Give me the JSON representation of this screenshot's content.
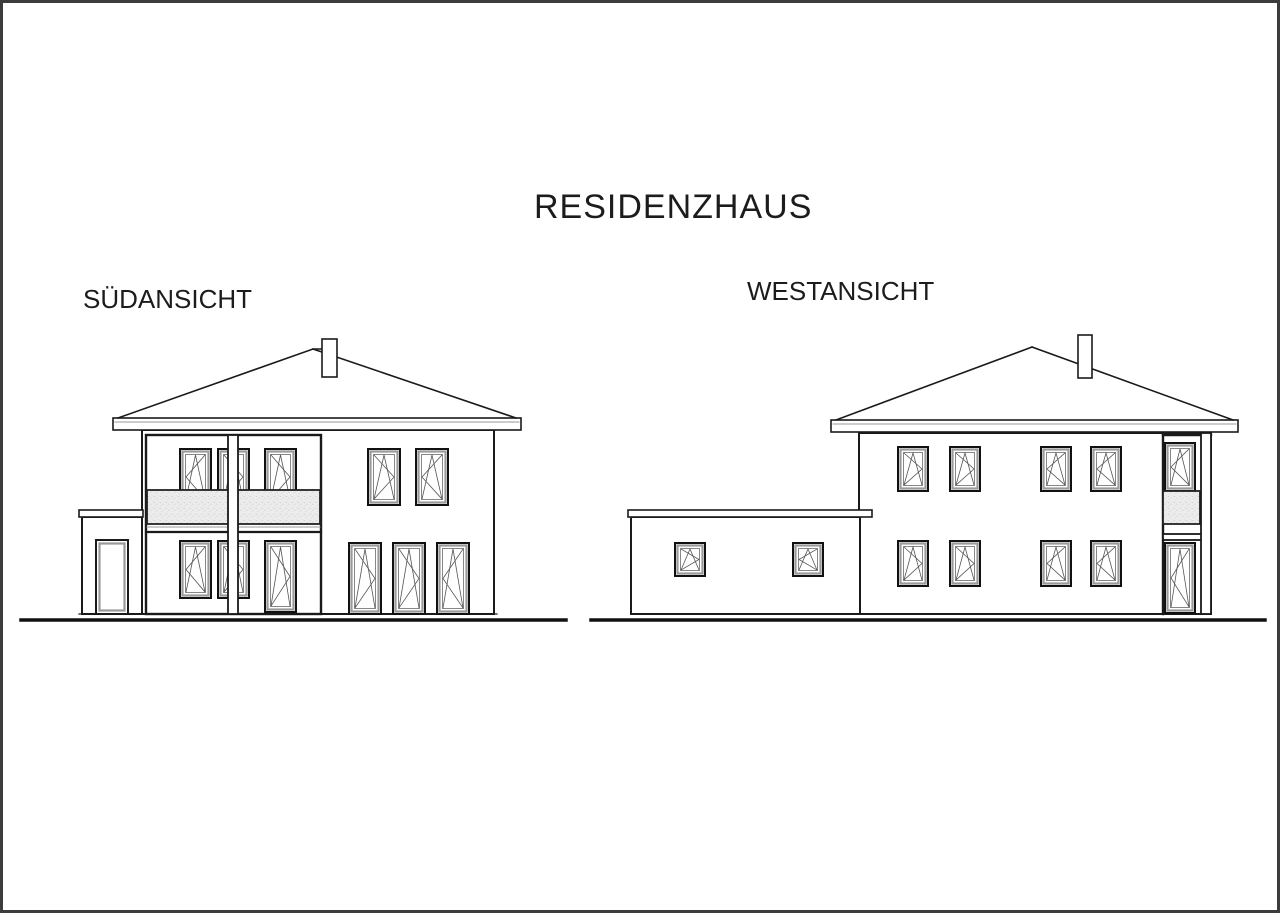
{
  "page": {
    "background_color": "#ffffff",
    "frame_color": "#3c3c3c"
  },
  "drawing": {
    "title": "RESIDENZHAUS",
    "views": [
      {
        "id": "sued",
        "label": "SÜDANSICHT",
        "summary": "Two-storey house, hipped roof with chimney, recessed balcony loggia with textured parapet and centre post, attached flat-roof annex with door, tilt-turn windows and french doors"
      },
      {
        "id": "west",
        "label": "WESTANSICHT",
        "summary": "Two-storey house, hipped roof with chimney, flat-roof garage annex with two small windows, four windows per floor, corner loggia with balcony parapet, upper window and lower glass door"
      }
    ],
    "colors": {
      "line": "#1a1a1a",
      "window_frame_gray": "#9a9a9a",
      "parapet_fill": "#ececec",
      "ground_line": "#111111"
    }
  }
}
